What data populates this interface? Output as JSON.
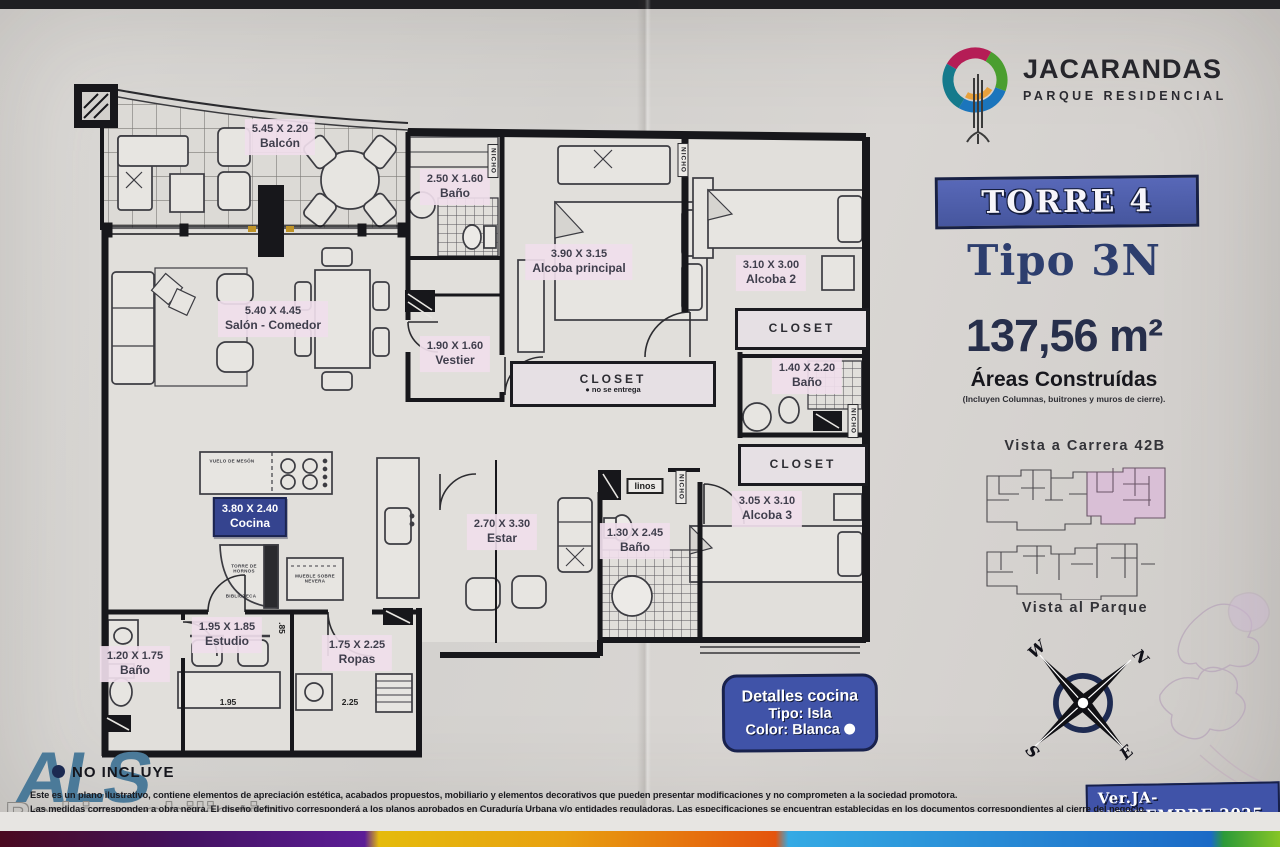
{
  "colors": {
    "banner_blue": "#4a59a9",
    "navy_text": "#2c3a66",
    "label_pink": "#f0dEec",
    "cocina_blue": "#35448f",
    "brand_steel_blue": "#4b7a99",
    "unit_highlight_pink": "#d9bfd6"
  },
  "brand": {
    "name": "JACARANDAS",
    "tagline": "PARQUE RESIDENCIAL"
  },
  "unit": {
    "tower": "TORRE 4",
    "tipo": "Tipo 3N",
    "area": "137,56 m²",
    "area_title": "Áreas Construídas",
    "area_note": "(Incluyen Columnas, buitrones y muros de cierre).",
    "view_top": "Vista a Carrera 42B",
    "view_bottom": "Vista al Parque",
    "version": "Ver.JA-NOVIEMBRE-2025"
  },
  "kitchen_badge": {
    "title": "Detalles cocina",
    "tipo": "Tipo: Isla",
    "color": "Color: Blanca"
  },
  "compass": {
    "n": "N",
    "s": "S",
    "e": "E",
    "w": "W"
  },
  "rooms": [
    {
      "dims": "5.45 X 2.20",
      "name": "Balcón"
    },
    {
      "dims": "2.50 X 1.60",
      "name": "Baño"
    },
    {
      "dims": "3.90 X 3.15",
      "name": "Alcoba principal"
    },
    {
      "dims": "3.10 X 3.00",
      "name": "Alcoba 2"
    },
    {
      "dims": "5.40 X 4.45",
      "name": "Salón - Comedor"
    },
    {
      "dims": "1.90 X 1.60",
      "name": "Vestier"
    },
    {
      "dims": "1.40 X 2.20",
      "name": "Baño"
    },
    {
      "dims": "3.80 X 2.40",
      "name": "Cocina"
    },
    {
      "dims": "2.70 X 3.30",
      "name": "Estar"
    },
    {
      "dims": "1.30 X 2.45",
      "name": "Baño"
    },
    {
      "dims": "3.05 X 3.10",
      "name": "Alcoba 3"
    },
    {
      "dims": "1.95 X 1.85",
      "name": "Estudio"
    },
    {
      "dims": "1.75 X 2.25",
      "name": "Ropas"
    },
    {
      "dims": "1.20 X 1.75",
      "name": "Baño"
    }
  ],
  "plan": {
    "closet": "CLOSET",
    "closet_note": "●  no se entrega",
    "nicho": "NICHO",
    "linos": "linos",
    "dim_estudio": "1.95",
    "dim_ropas": "2.25",
    "dim_mid": ".85",
    "note_vuelo": "VUELO DE MESÓN",
    "note_hornos": "TORRE DE HORNOS",
    "note_biblioteca": "BIBLIOTECA",
    "note_nevera": "MUEBLE SOBRE NEVERA"
  },
  "footer": {
    "no_incluye": "NO INCLUYE",
    "line1": "Este es un plano ilustrativo, contiene elementos de apreciación estética, acabados propuestos, mobiliario y elementos decorativos que pueden presentar modificaciones y no comprometen a la sociedad promotora.",
    "line2": "Las medidas corresponden a obra negra.  El diseño definitivo corresponderá a los planos aprobados en Curaduría Urbana y/o entidades reguladoras. Las especificaciones se encuentran establecidas en los documentos correspondientes al cierre del negocio.",
    "agency": "ALS",
    "agency_sub": "Red inmobiliaria"
  }
}
